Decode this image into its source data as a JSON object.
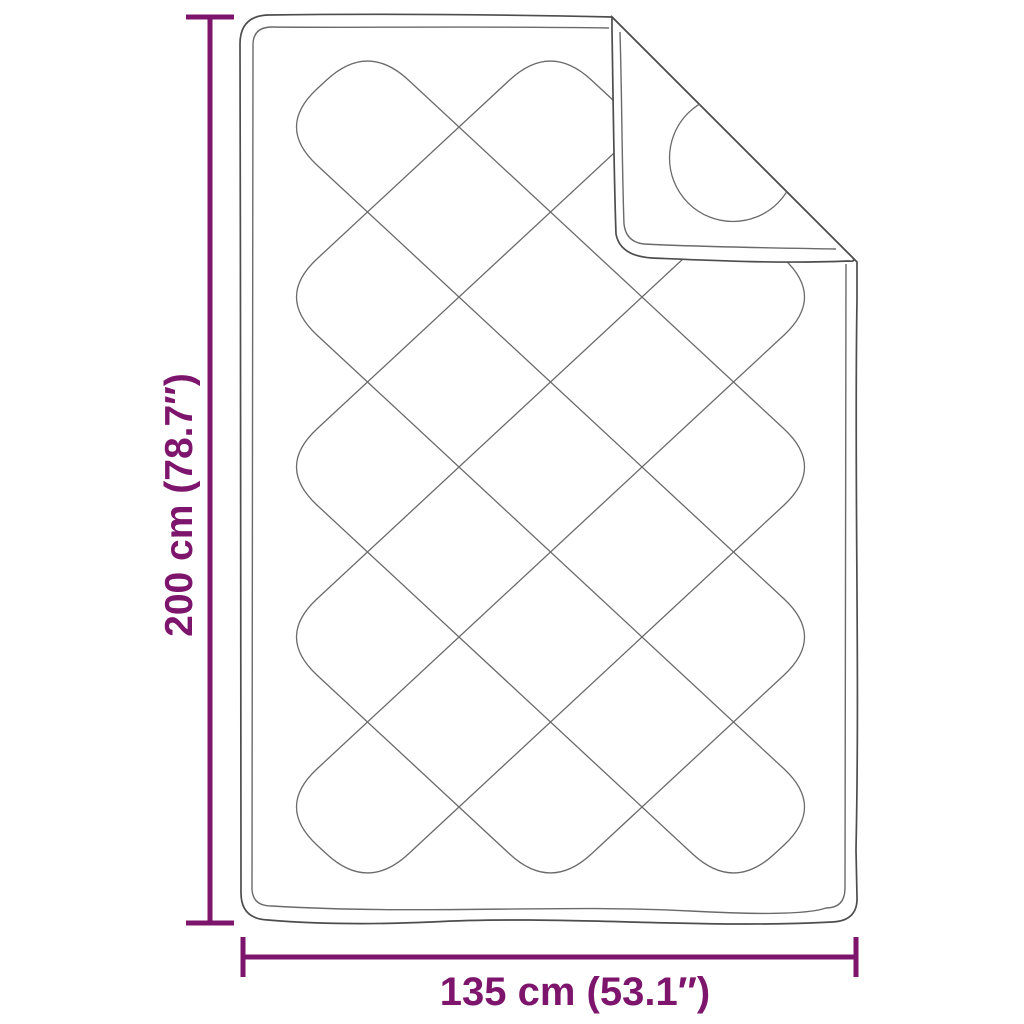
{
  "dimensions": {
    "vertical_label": "200 cm (78.7″)",
    "horizontal_label": "135 cm (53.1″)"
  },
  "colors": {
    "dimension_accent": "#7E156D",
    "outline": "#4D4D4D",
    "quilt_line": "#6A6A6A",
    "background": "#FFFFFF"
  }
}
